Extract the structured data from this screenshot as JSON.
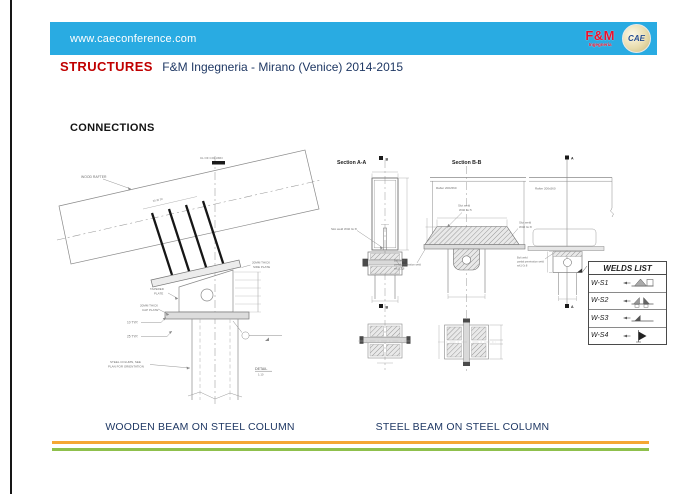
{
  "header": {
    "url": "www.caeconference.com",
    "fm_logo_text": "F&M",
    "fm_logo_sub": "Ingegneria",
    "cae_logo_text": "CAE"
  },
  "title": {
    "keyword": "STRUCTURES",
    "subtitle": "F&M Ingegneria - Mirano (Venice) 2014-2015"
  },
  "heading": "CONNECTIONS",
  "left_drawing": {
    "wood_rafter": "WOOD RAFTER",
    "centerline": "CL OF COLUMN",
    "rod_dims": "30  30  30",
    "tapered_l1": "TAPERED",
    "tapered_l2": "PLATE",
    "cap_l1": "20MM THICK",
    "cap_l2": "CAP PLATE",
    "side_l1": "20MM THICK",
    "side_l2": "SIDE PLATE",
    "typ10": "10 TYP.",
    "typ25": "25 TYP.",
    "column_l1": "STEEL COLUMN, SEE",
    "column_l2": "PLAN FOR ORIENTATION",
    "detail": "DETAIL",
    "detail_scale": "1:10"
  },
  "section_aa": {
    "title": "Section A-A",
    "marker": "B",
    "slot_weld": "Slot weld W40 Gr.8",
    "pen_weld_l1": "Bolt weld",
    "pen_weld_l2": "partial penetration weld",
    "pen_weld_l3": "w/t1 Gr.8"
  },
  "section_bb": {
    "title": "Section B-B",
    "rafter": "Rafter 200x560",
    "slot_weld_c_l1": "Slot weld",
    "slot_weld_c_l2": "W40 Gr.5",
    "slot_weld_r_l1": "Slot weld",
    "slot_weld_r_l2": "W40 Gr.8",
    "pen_weld_l1": "Bolt weld",
    "pen_weld_l2": "partial penetration weld",
    "pen_weld_l3": "w/t1 Gr.8"
  },
  "elevation": {
    "marker": "A",
    "rafter": "Rafter 200x560"
  },
  "welds_list": {
    "title": "WELDS LIST",
    "rows": [
      "W-S1",
      "W-S2",
      "W-S3",
      "W-S4"
    ]
  },
  "captions": {
    "left": "WOODEN BEAM ON STEEL COLUMN",
    "right": "STEEL BEAM ON STEEL COLUMN"
  },
  "colors": {
    "header_blue": "#29ABE2",
    "accent_red": "#C00000",
    "navy_text": "#1F3864",
    "footer_orange": "#F5A733",
    "footer_green": "#8FC04C",
    "logo_red": "#E8112D"
  }
}
